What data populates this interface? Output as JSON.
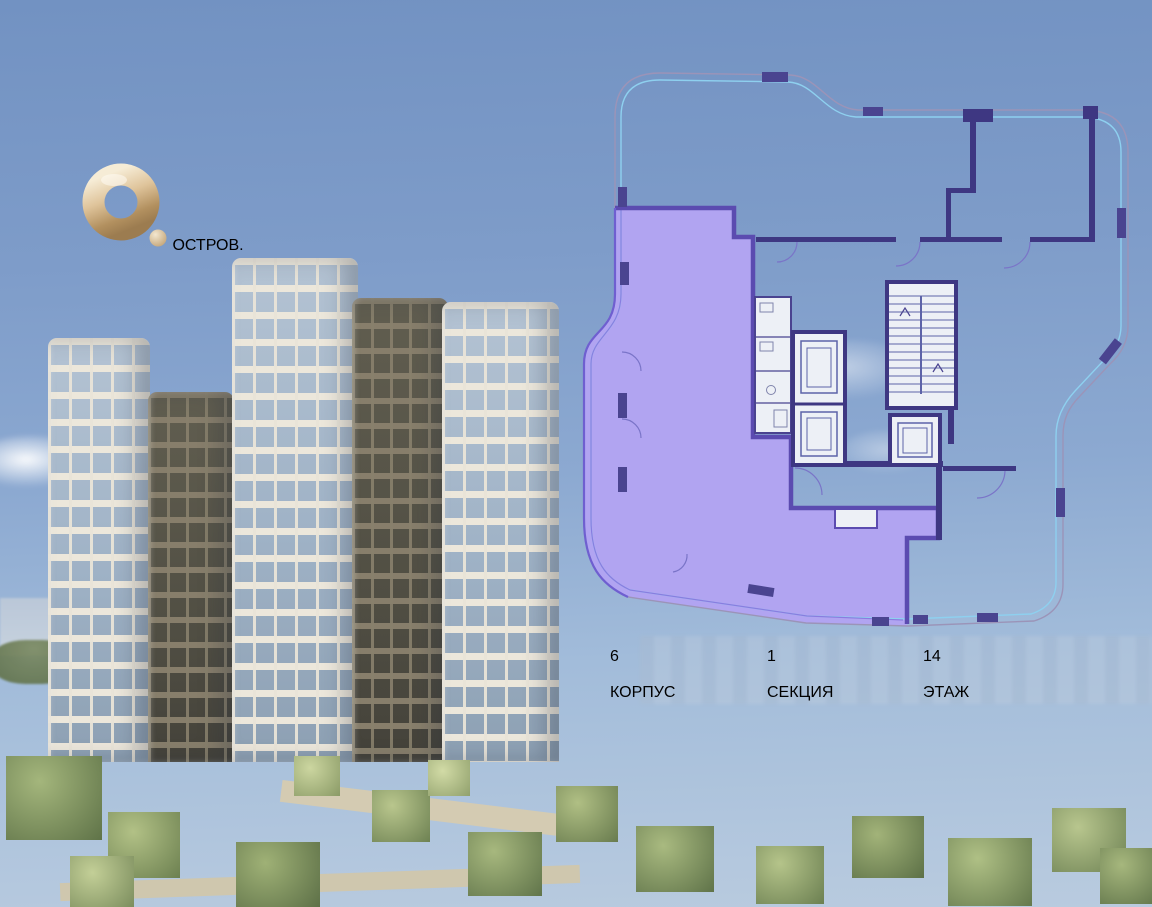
{
  "brand": {
    "name": "ОСТРОВ.",
    "logo_mark": "gold-ring-with-dot"
  },
  "panel": {
    "info": {
      "items": [
        {
          "value": "6",
          "label": "КОРПУС"
        },
        {
          "value": "1",
          "label": "СЕКЦИЯ"
        },
        {
          "value": "14",
          "label": "ЭТАЖ"
        }
      ]
    },
    "floorplan": {
      "highlight_color": "#b1a4f1",
      "highlight_border": "#5b4bb0",
      "wall_color": "#3e3782",
      "glazing_color": "#8ed0ef",
      "selected_area_name": "apartment-on-floor-14"
    }
  },
  "colors": {
    "accent_purple": "#54489c",
    "label_dark": "#1a1a1f",
    "gold": "#d9bf98",
    "panel_bg": "#eceff5"
  }
}
